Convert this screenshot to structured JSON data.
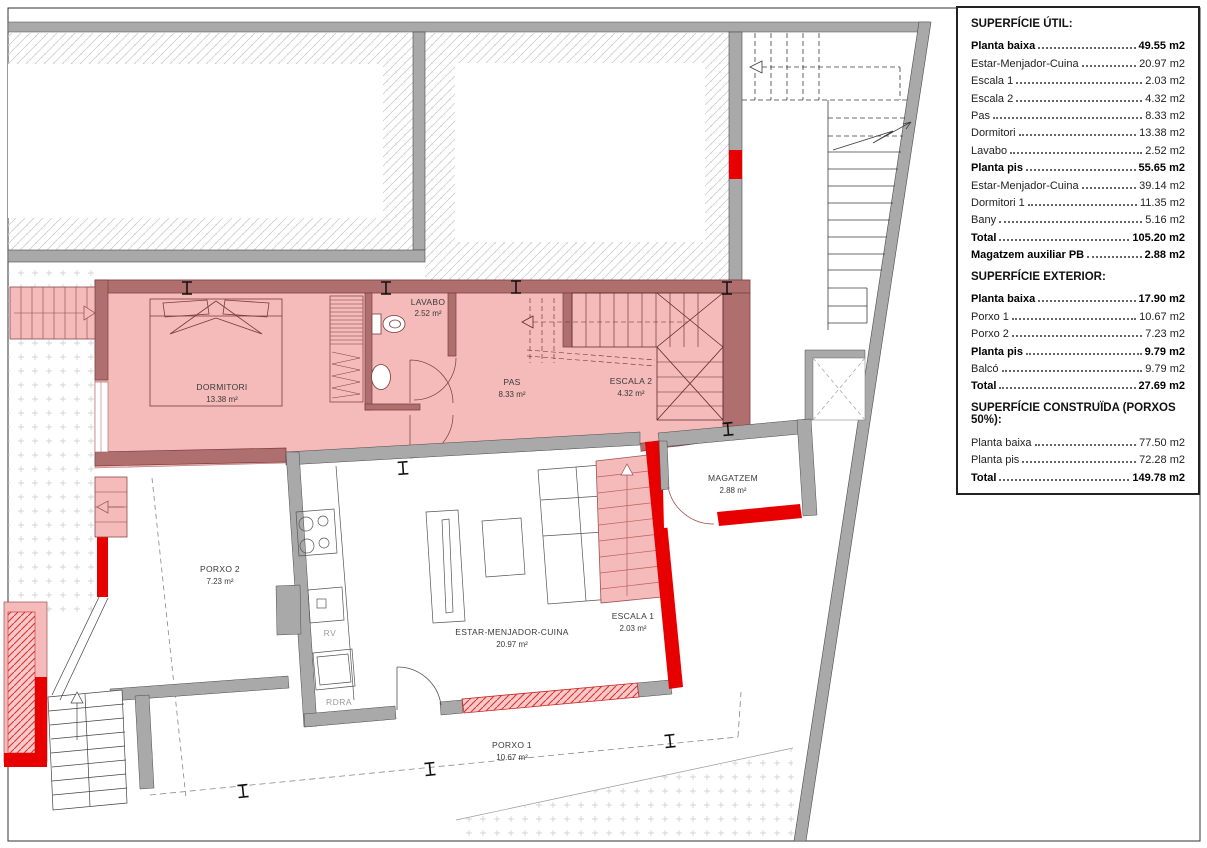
{
  "plan": {
    "rooms": {
      "dormitori": {
        "name": "DORMITORI",
        "area": "13.38 m²"
      },
      "lavabo": {
        "name": "LAVABO",
        "area": "2.52 m²"
      },
      "pas": {
        "name": "PAS",
        "area": "8.33 m²"
      },
      "escala2": {
        "name": "ESCALA 2",
        "area": "4.32 m²"
      },
      "estar": {
        "name": "ESTAR-MENJADOR-CUINA",
        "area": "20.97 m²"
      },
      "escala1": {
        "name": "ESCALA 1",
        "area": "2.03 m²"
      },
      "magatzem": {
        "name": "MAGATZEM",
        "area": "2.88 m²"
      },
      "porxo2": {
        "name": "PORXO 2",
        "area": "7.23 m²"
      },
      "porxo1": {
        "name": "PORXO 1",
        "area": "10.67 m²"
      }
    },
    "annotations": {
      "rv": "RV",
      "rdra": "RDRA"
    },
    "colors": {
      "new_element_red": "#e80000",
      "upper_floor_overlay_pink": "#f5baba",
      "upper_floor_wall": "#b06f6f",
      "wall_gray": "#a9a9a9"
    }
  },
  "legend": {
    "sections": [
      {
        "title": "SUPERFÍCIE ÚTIL:",
        "rows": [
          {
            "label": "Planta baixa",
            "value": "49.55 m2",
            "bold": true
          },
          {
            "label": "Estar-Menjador-Cuina",
            "value": "20.97 m2",
            "bold": false
          },
          {
            "label": "Escala 1",
            "value": "2.03 m2",
            "bold": false
          },
          {
            "label": "Escala 2",
            "value": "4.32 m2",
            "bold": false
          },
          {
            "label": "Pas",
            "value": "8.33 m2",
            "bold": false
          },
          {
            "label": "Dormitori",
            "value": "13.38 m2",
            "bold": false
          },
          {
            "label": "Lavabo",
            "value": "2.52 m2",
            "bold": false
          },
          {
            "label": "Planta pis",
            "value": "55.65 m2",
            "bold": true
          },
          {
            "label": "Estar-Menjador-Cuina",
            "value": "39.14 m2",
            "bold": false
          },
          {
            "label": "Dormitori 1",
            "value": "11.35 m2",
            "bold": false
          },
          {
            "label": "Bany",
            "value": "5.16 m2",
            "bold": false
          },
          {
            "label": "Total",
            "value": "105.20 m2",
            "bold": true
          },
          {
            "label": "Magatzem auxiliar PB",
            "value": "2.88 m2",
            "bold": true
          }
        ]
      },
      {
        "title": "SUPERFÍCIE EXTERIOR:",
        "rows": [
          {
            "label": "Planta baixa",
            "value": "17.90 m2",
            "bold": true
          },
          {
            "label": "Porxo 1",
            "value": "10.67 m2",
            "bold": false
          },
          {
            "label": "Porxo 2",
            "value": "7.23 m2",
            "bold": false
          },
          {
            "label": "Planta pis",
            "value": "9.79 m2",
            "bold": true
          },
          {
            "label": "Balcó",
            "value": "9.79 m2",
            "bold": false
          },
          {
            "label": "Total",
            "value": "27.69 m2",
            "bold": true
          }
        ]
      },
      {
        "title": "SUPERFÍCIE CONSTRUÏDA (PORXOS 50%):",
        "rows": [
          {
            "label": "Planta baixa",
            "value": "77.50 m2",
            "bold": false
          },
          {
            "label": "Planta pis",
            "value": "72.28 m2",
            "bold": false
          },
          {
            "label": "Total",
            "value": "149.78 m2",
            "bold": true
          }
        ]
      }
    ]
  }
}
